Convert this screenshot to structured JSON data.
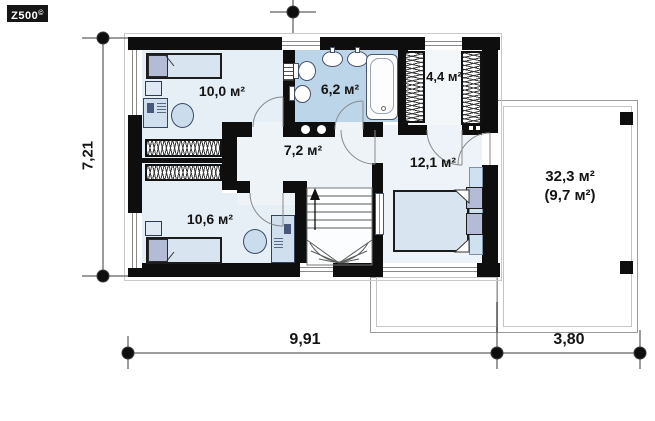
{
  "logo": {
    "brand": "Z500",
    "mark": "©"
  },
  "plan": {
    "type": "second-floor plan",
    "rooms": [
      {
        "name": "bedroom-upper-left",
        "area_label": "10,0 м²"
      },
      {
        "name": "bathroom",
        "area_label": "6,2 м²"
      },
      {
        "name": "wardrobe",
        "area_label": "4,4 м²"
      },
      {
        "name": "hall",
        "area_label": "7,2 м²"
      },
      {
        "name": "bedroom-right",
        "area_label": "12,1 м²"
      },
      {
        "name": "bedroom-lower-left",
        "area_label": "10,6 м²"
      }
    ],
    "terrace": {
      "name": "terrace",
      "area_label": "32,3 м²",
      "area_label_secondary": "(9,7 м²)"
    },
    "symbols": [
      "bed",
      "pillow",
      "nightstand",
      "desk",
      "office-chair",
      "toilet",
      "bidet",
      "washbasin",
      "bathtub",
      "washer-dryer",
      "wardrobe-rail",
      "winder-stairs",
      "stairs-up-arrow",
      "radiator",
      "vent-shaft",
      "terrace-post"
    ]
  },
  "dimensions": {
    "overall_width": "9,91",
    "terrace_width": "3,80",
    "overall_depth": "7,21"
  },
  "colors": {
    "wall": "#0e0e0e",
    "bathroom_floor": "#bcd5e9",
    "room_floor": "#e6eef6",
    "bedroom_floor": "#edf3f8",
    "furniture_accent": "#b3bbd6",
    "bed_fill": "#d8e5f1",
    "terrace_outline": "#9a9a9a"
  }
}
